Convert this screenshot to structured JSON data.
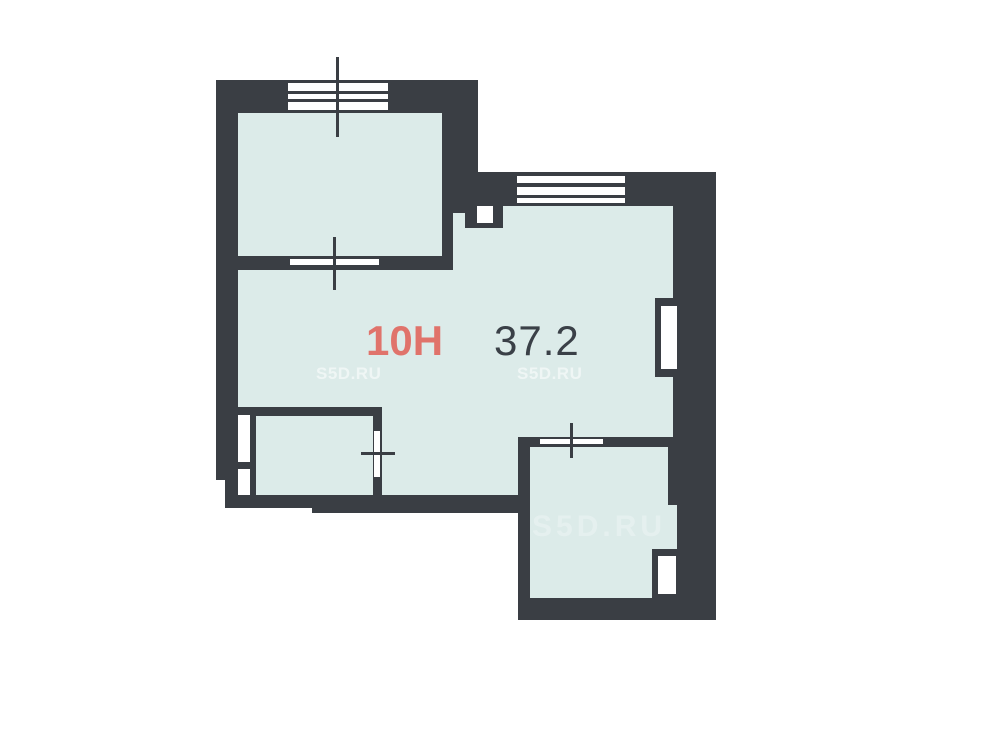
{
  "floorplan": {
    "unit_number": "10H",
    "area_value": "37.2",
    "watermark_text": "S5D.RU"
  },
  "colors": {
    "wall": "#3a3e44",
    "floor": "#dcebe9",
    "opening": "#ffffff",
    "accent": "#e0736b",
    "area_text": "#3a4047",
    "watermark": "rgba(255,255,255,0.55)",
    "watermark_faint": "rgba(255,255,255,0.28)"
  }
}
